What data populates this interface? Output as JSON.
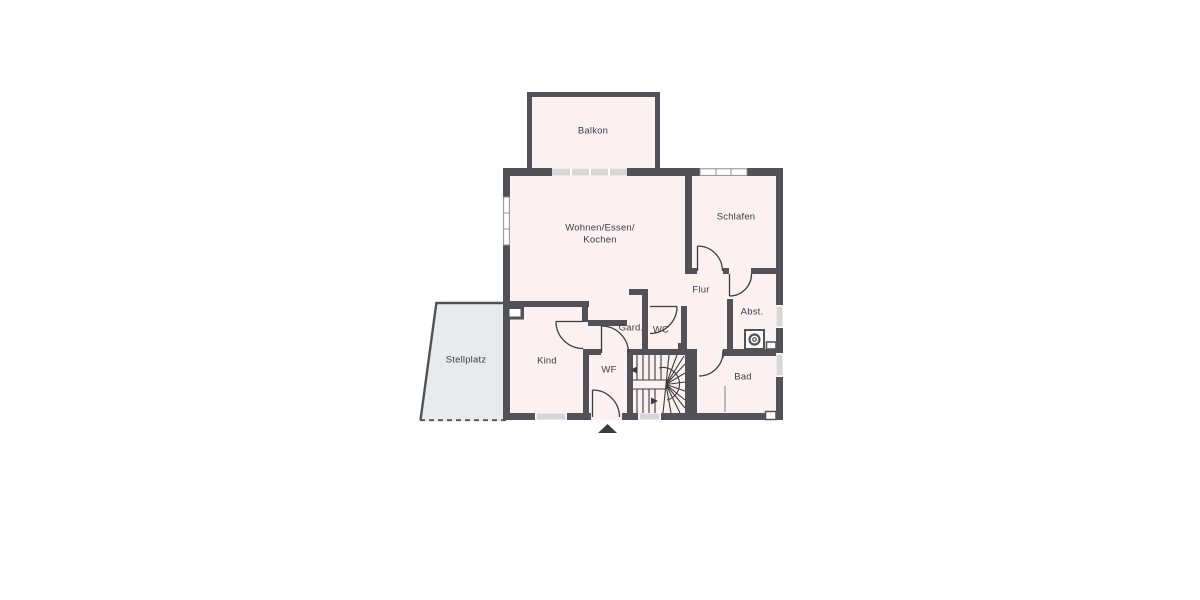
{
  "title": "Apartment floor plan",
  "colors": {
    "background": "#ffffff",
    "wall": "#515157",
    "room_fill": "#faf1f0",
    "stellplatz_fill": "#e8eaeb",
    "glass": "#d4d6d9",
    "window_frame": "#8f9094",
    "line": "#3c3c40",
    "text": "#3c3c40"
  },
  "rooms": {
    "balkon": {
      "label": "Balkon"
    },
    "wohnen": {
      "label_line1": "Wohnen/Essen/",
      "label_line2": "Kochen"
    },
    "schlafen": {
      "label": "Schlafen"
    },
    "flur": {
      "label": "Flur"
    },
    "abstellraum": {
      "label": "Abst."
    },
    "garderobe": {
      "label": "Gard."
    },
    "wc": {
      "label": "WC"
    },
    "kind": {
      "label": "Kind"
    },
    "windfang": {
      "label": "WF"
    },
    "bad": {
      "label": "Bad"
    },
    "stellplatz": {
      "label": "Stellplatz"
    }
  },
  "icons": {
    "washing_machine": "washing-machine",
    "entrance_arrow": "entrance-direction-arrow",
    "chimney": "chimney-shaft",
    "stairs": "winder-staircase"
  }
}
